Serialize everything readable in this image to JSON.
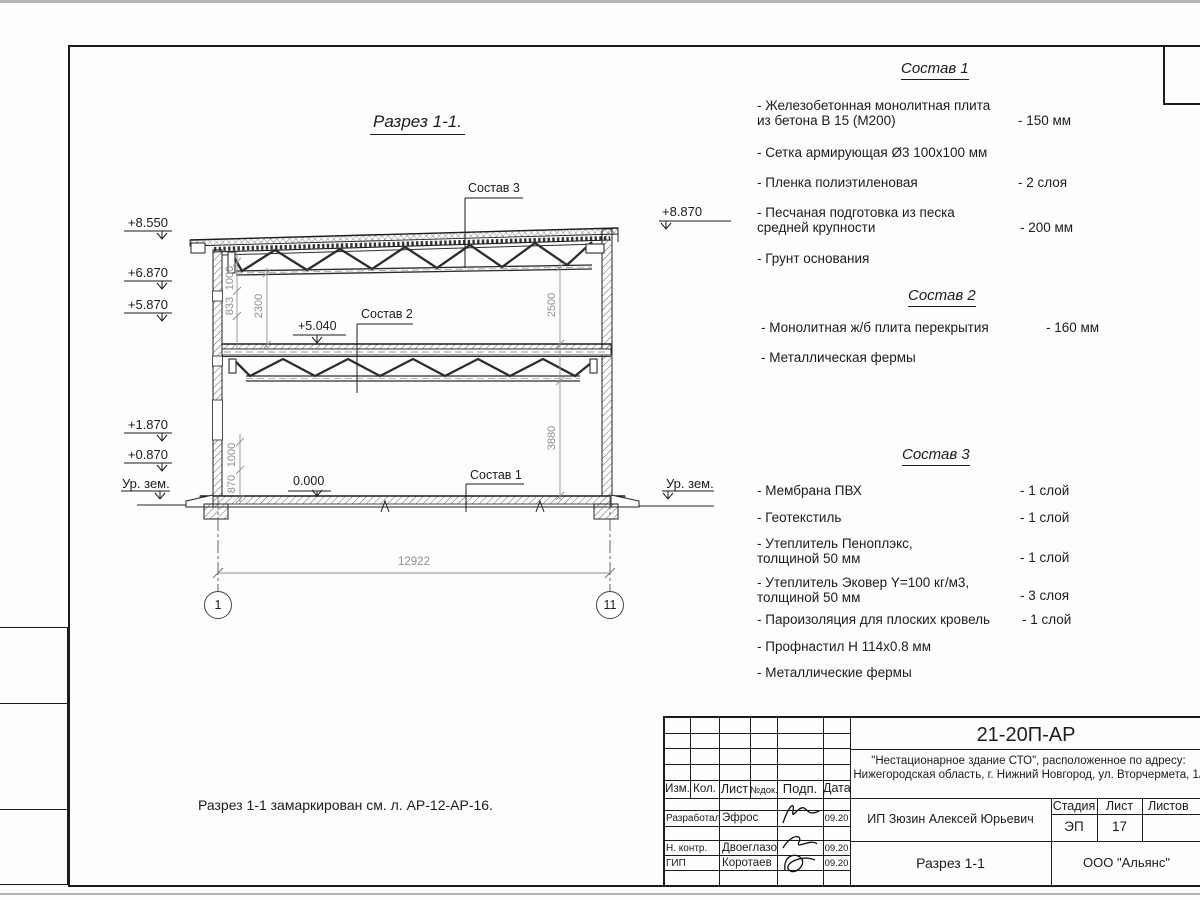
{
  "drawing": {
    "title": "Разрез 1-1.",
    "note": "Разрез 1-1 замаркирован см. л. АР-12-АР-16.",
    "elev_left": [
      "+8.550",
      "+6.870",
      "+5.870",
      "+1.870",
      "+0.870"
    ],
    "elev_right": "+8.870",
    "ground_left": "Ур. зем.",
    "ground_right": "Ур. зем.",
    "level_zero": "0.000",
    "level_mid": "+5.040",
    "callout_roof": "Состав 3",
    "callout_mid": "Состав 2",
    "callout_floor": "Состав 1",
    "dims": {
      "span": "12922",
      "h1000_top": "1000",
      "h833": "833",
      "h2300": "2300",
      "h1000_bot": "1000",
      "h870": "870",
      "h2500": "2500",
      "h3880": "3880"
    },
    "axes": [
      "1",
      "11"
    ]
  },
  "compositions": [
    {
      "title": "Состав 1",
      "items": [
        {
          "name": "- Железобетонная  монолитная плита\nиз бетона В 15 (М200)",
          "qty": "- 150 мм"
        },
        {
          "name": "- Сетка армирующая Ø3 100x100 мм",
          "qty": ""
        },
        {
          "name": "- Пленка полиэтиленовая",
          "qty": "-  2 слоя"
        },
        {
          "name": "- Песчаная подготовка из песка\nсредней крупности",
          "qty": "- 200 мм"
        },
        {
          "name": "- Грунт основания",
          "qty": ""
        }
      ]
    },
    {
      "title": "Состав 2",
      "items": [
        {
          "name": "- Монолитная ж/б плита перекрытия",
          "qty": "- 160 мм"
        },
        {
          "name": "- Металлическая фермы",
          "qty": ""
        }
      ]
    },
    {
      "title": "Состав 3",
      "items": [
        {
          "name": "- Мембрана ПВХ",
          "qty": "- 1 слой"
        },
        {
          "name": "- Геотекстиль",
          "qty": "- 1 слой"
        },
        {
          "name": "- Утеплитель Пеноплэкс,\nтолщиной 50 мм",
          "qty": "- 1 слой"
        },
        {
          "name": "- Утеплитель Эковер Y=100 кг/м3,\nтолщиной 50 мм",
          "qty": "- 3 слоя"
        },
        {
          "name": "- Пароизоляция для плоских кровель",
          "qty": "- 1 слой"
        },
        {
          "name": "- Профнастил Н 114x0.8 мм",
          "qty": ""
        },
        {
          "name": "- Металлические фермы",
          "qty": ""
        }
      ]
    }
  ],
  "titleblock": {
    "doc_number": "21-20П-АР",
    "project_line1": "\"Нестационарное здание СТО\", расположенное по адресу:",
    "project_line2": "Нижегородская область, г. Нижний Новгород, ул. Вторчермета, 1А",
    "client": "ИП Зюзин Алексей Юрьевич",
    "sheet_title": "Разрез 1-1",
    "company": "ООО \"Альянс\"",
    "cols": {
      "izm": "Изм.",
      "kol": "Кол.",
      "list": "Лист",
      "ndok": "№док.",
      "podp": "Подп.",
      "data": "Дата"
    },
    "stage_label": "Стадия",
    "sheet_label": "Лист",
    "sheets_label": "Листов",
    "stage": "ЭП",
    "sheet_no": "17",
    "rows": [
      {
        "role": "Разработал",
        "name": "Эфрос",
        "date": "09.20"
      },
      {
        "role": "Н. контр.",
        "name": "Двоеглазов",
        "date": "09.20"
      },
      {
        "role": "ГИП",
        "name": "Коротаев",
        "date": "09.20"
      }
    ]
  }
}
